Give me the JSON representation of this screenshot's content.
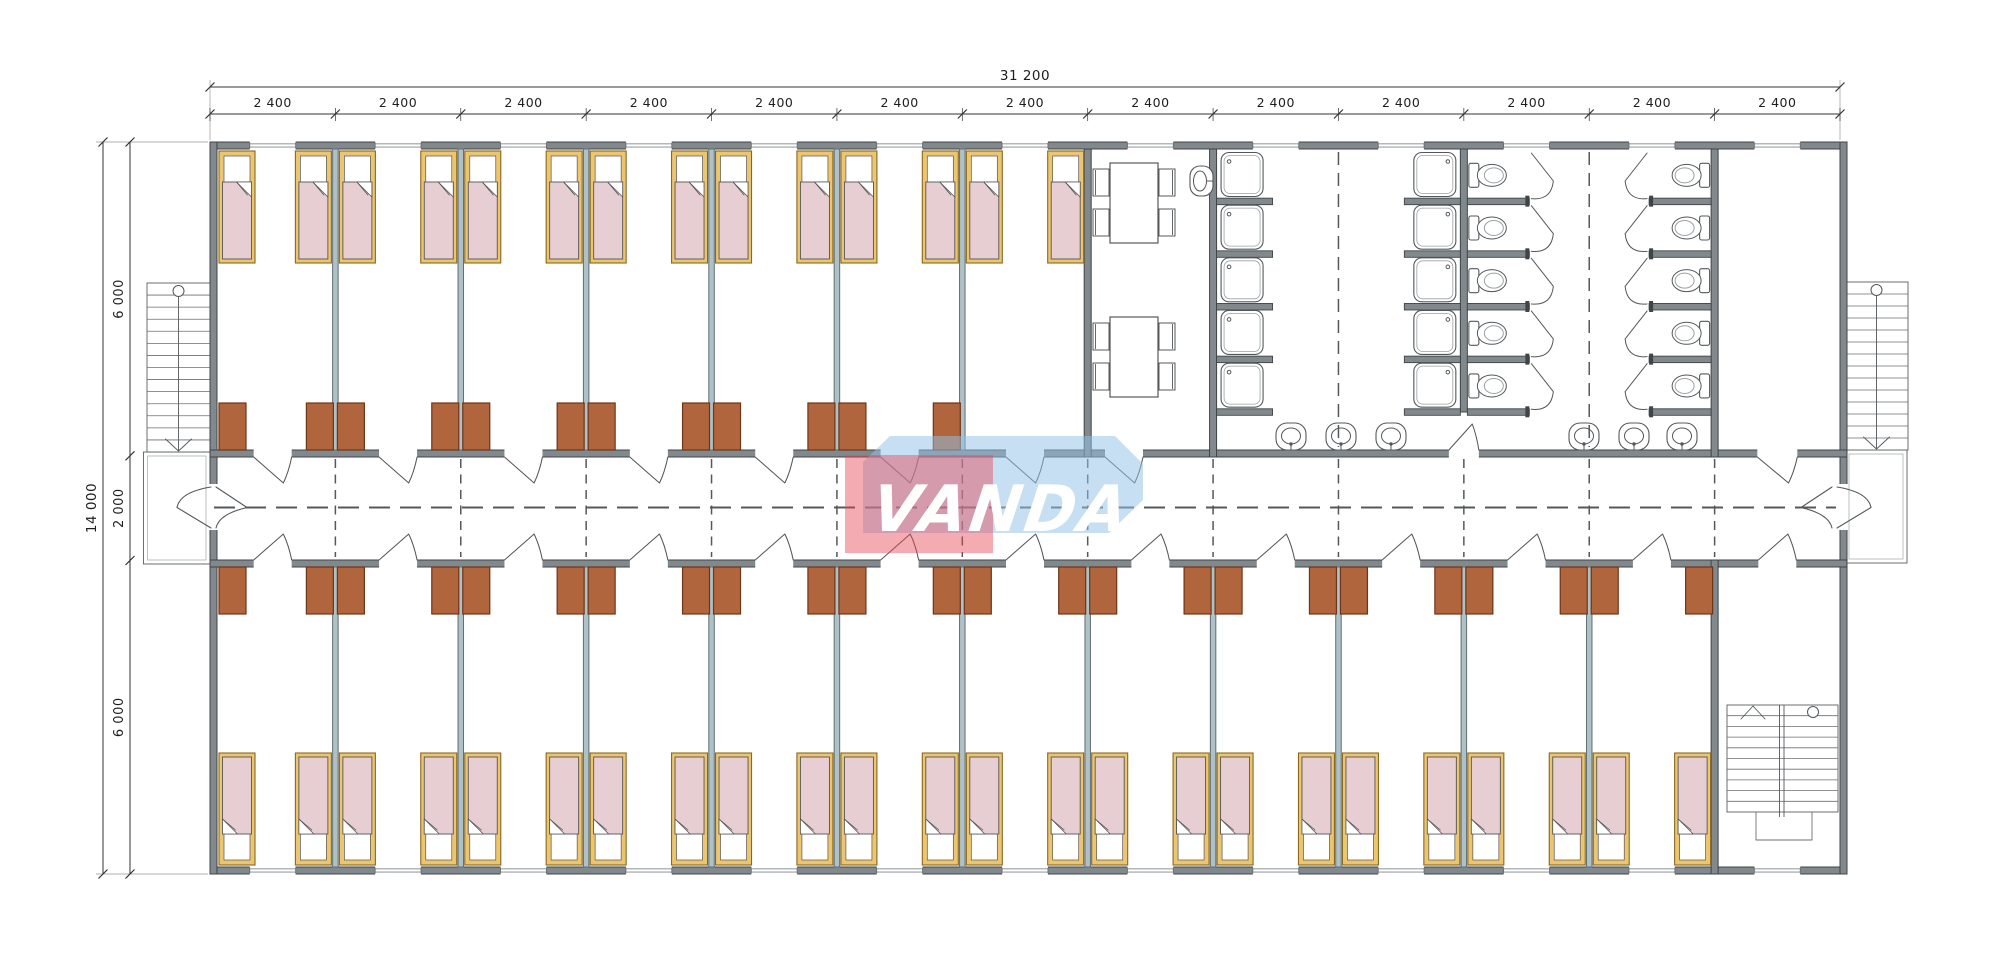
{
  "drawing": {
    "kind": "dormitory-container-building-floor-plan",
    "logo": {
      "text": "VANDA",
      "red": "rgba(230,72,84,0.45)",
      "blue": "rgba(148,193,230,0.52)",
      "text_color": "#ffffff"
    },
    "dimensions": {
      "overall_width_label": "31 200",
      "bay_width_label": "2 400",
      "bay_count": 13,
      "overall_height_label": "14 000",
      "height_segment_labels": [
        "6 000",
        "2 000",
        "6 000"
      ]
    },
    "colors": {
      "background": "#ffffff",
      "wall": "#82898d",
      "wall_edge": "#3f4447",
      "partition": "#aec1c7",
      "partition_edge": "#5f6e74",
      "wardrobe": "#b0653c",
      "wardrobe_edge": "#6e3518",
      "bed_frame": "#ecc570",
      "bed_frame_edge": "#8a6820",
      "pillow": "#ffffff",
      "blanket": "#e6ced3",
      "fixture_line": "#54585b",
      "glazing": "#9aa0a3",
      "dash": "#54585b",
      "dim_line": "#333333",
      "dim_text": "#1e1e1e"
    },
    "counts": {
      "bedrooms_top_row": 7,
      "bedrooms_bottom_row": 12,
      "beds": 38,
      "wardrobes": 36,
      "shower_stalls": 10,
      "toilets": 10,
      "wash_basins": 7,
      "dining_tables": 2,
      "dining_chairs": 8,
      "exterior_staircases": 2,
      "interior_staircases": 1,
      "windows": 26
    }
  }
}
